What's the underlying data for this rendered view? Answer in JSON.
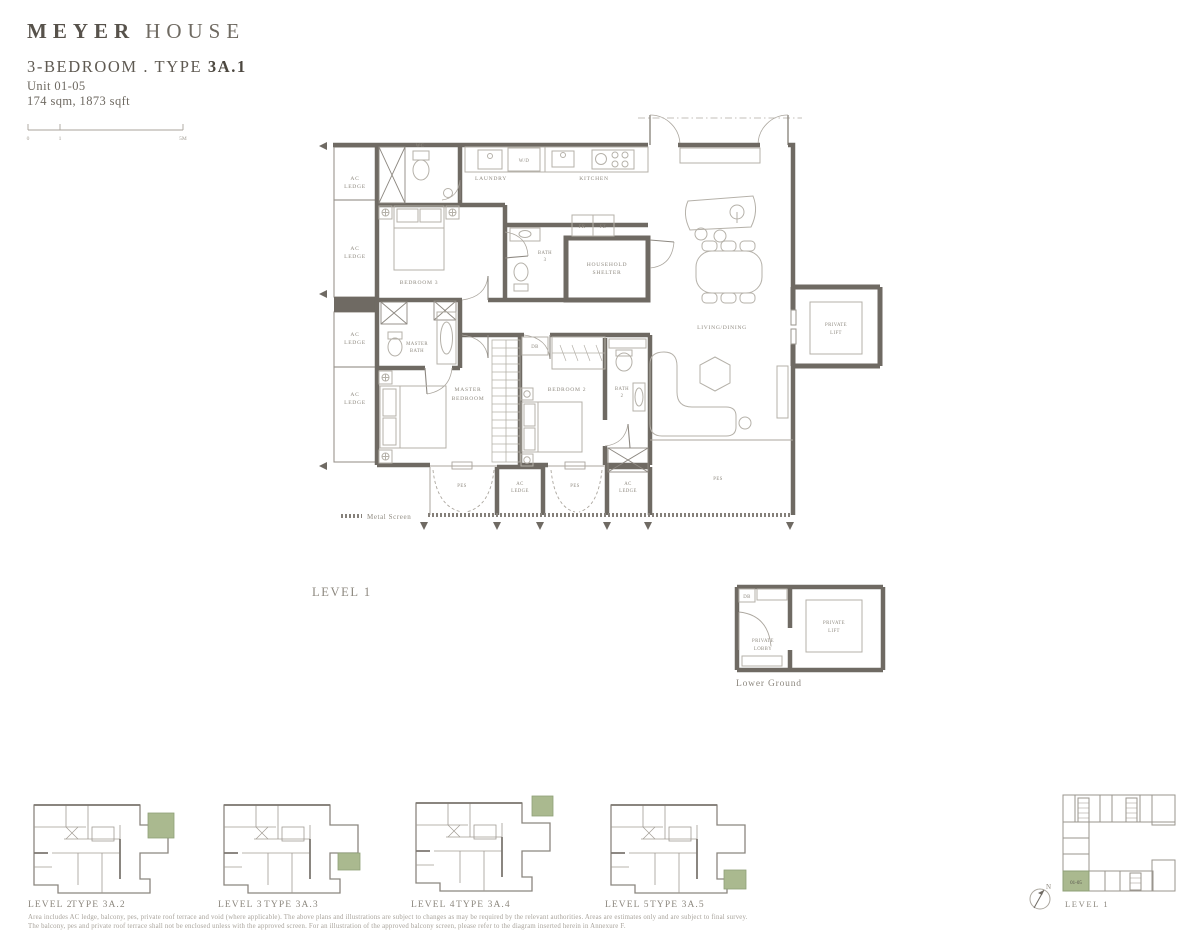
{
  "header": {
    "brand_primary": "MEYER",
    "brand_secondary": "HOUSE",
    "unit_type_prefix": "3-BEDROOM . TYPE ",
    "unit_type_bold": "3A.1",
    "unit_range": "Unit 01-05",
    "area": "174 sqm, 1873 sqft"
  },
  "scale_bar": {
    "tick0": "0",
    "tick1": "1",
    "tick2": "5M"
  },
  "main_plan": {
    "level_label": "LEVEL 1",
    "legend_metal_screen": "Metal Screen",
    "labels": {
      "ac": "AC",
      "ledge": "LEDGE",
      "wc": "WC",
      "laundry": "LAUNDRY",
      "wd": "W/D",
      "kitchen": "KITCHEN",
      "bedroom3": "BEDROOM 3",
      "bath": "BATH",
      "bath3_num": "3",
      "bath2_num": "2",
      "household_1": "HOUSEHOLD",
      "household_2": "SHELTER",
      "fr": "FR",
      "fz": "FZ",
      "living_dining": "LIVING/DINING",
      "private": "PRIVATE",
      "lift": "LIFT",
      "master": "MASTER",
      "bedroom": "BEDROOM",
      "bedroom2": "BEDROOM 2",
      "db": "DB",
      "pes": "PES"
    }
  },
  "lower_ground_plan": {
    "caption": "Lower Ground",
    "labels": {
      "db": "DB",
      "private": "PRIVATE",
      "lobby": "LOBBY",
      "lift": "LIFT"
    }
  },
  "thumbnails": [
    {
      "level": "LEVEL 2",
      "type": "TYPE 3A.2"
    },
    {
      "level": "LEVEL 3",
      "type": "TYPE 3A.3"
    },
    {
      "level": "LEVEL 4",
      "type": "TYPE 3A.4"
    },
    {
      "level": "LEVEL 5",
      "type": "TYPE 3A.5"
    }
  ],
  "key_plan": {
    "level": "LEVEL 1",
    "unit_label": "01-05",
    "north": "N"
  },
  "disclaimer": {
    "line1": "Area includes AC ledge, balcony, pes, private roof terrace and void (where applicable). The above plans and illustrations are subject to changes as may be required by the relevant authorities. Areas are estimates only and are subject to final survey.",
    "line2": "The balcony, pes and private roof terrace shall not be enclosed unless with the approved screen. For an illustration of the approved balcony screen, please refer to the diagram inserted herein in Annexure F."
  },
  "colors": {
    "wall": "#6f6a63",
    "furniture_line": "#b5b1a9",
    "label_text": "#8f8a80",
    "heading_text": "#57524b",
    "highlight_green": "#aab98f"
  }
}
